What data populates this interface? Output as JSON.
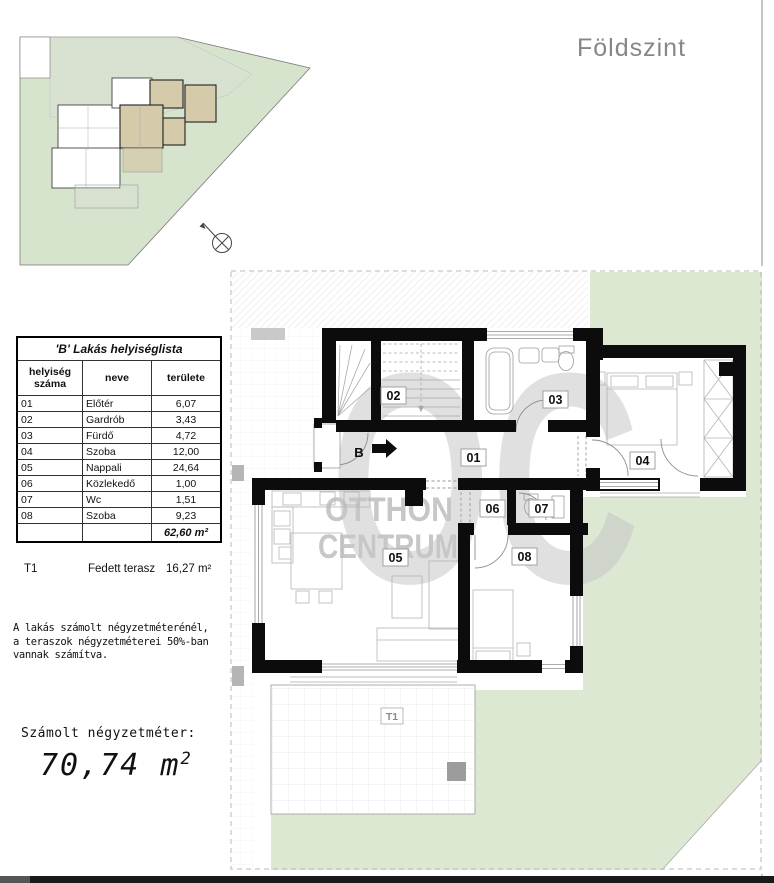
{
  "title": "Földszint",
  "table": {
    "title": "'B' Lakás helyiséglista",
    "headers": {
      "num": "helyiség száma",
      "name": "neve",
      "area": "területe"
    },
    "rows": [
      {
        "num": "01",
        "name": "Előtér",
        "area": "6,07"
      },
      {
        "num": "02",
        "name": "Gardrób",
        "area": "3,43"
      },
      {
        "num": "03",
        "name": "Fürdő",
        "area": "4,72"
      },
      {
        "num": "04",
        "name": "Szoba",
        "area": "12,00"
      },
      {
        "num": "05",
        "name": "Nappali",
        "area": "24,64"
      },
      {
        "num": "06",
        "name": "Közlekedő",
        "area": "1,00"
      },
      {
        "num": "07",
        "name": "Wc",
        "area": "1,51"
      },
      {
        "num": "08",
        "name": "Szoba",
        "area": "9,23"
      }
    ],
    "total": "62,60 m²"
  },
  "terrace_line": {
    "code": "T1",
    "name": "Fedett terasz",
    "area": "16,27 m²"
  },
  "note": "A lakás számolt négyzetméterénél,\na teraszok négyzetméterei 50%-ban\nvannak számítva.",
  "computed": {
    "label": "Számolt négyzetméter:",
    "value": "70,74",
    "unit": "m",
    "sup": "2"
  },
  "plan": {
    "labels": {
      "r01": "01",
      "r02": "02",
      "r03": "03",
      "r04": "04",
      "r05": "05",
      "r06": "06",
      "r07": "07",
      "r08": "08",
      "b": "B",
      "t1": "T1"
    }
  },
  "watermark": {
    "monogram": "OC",
    "line1": "OTTHON",
    "line2": "CENTRUM"
  },
  "colors": {
    "lawn": "#dde8d3",
    "site_lawn": "#d6e3cd",
    "apartment_highlight": "#d5caaa",
    "watermark": "#c7c7c7",
    "wall": "#0c0c0c",
    "floor_title": "#878787"
  }
}
